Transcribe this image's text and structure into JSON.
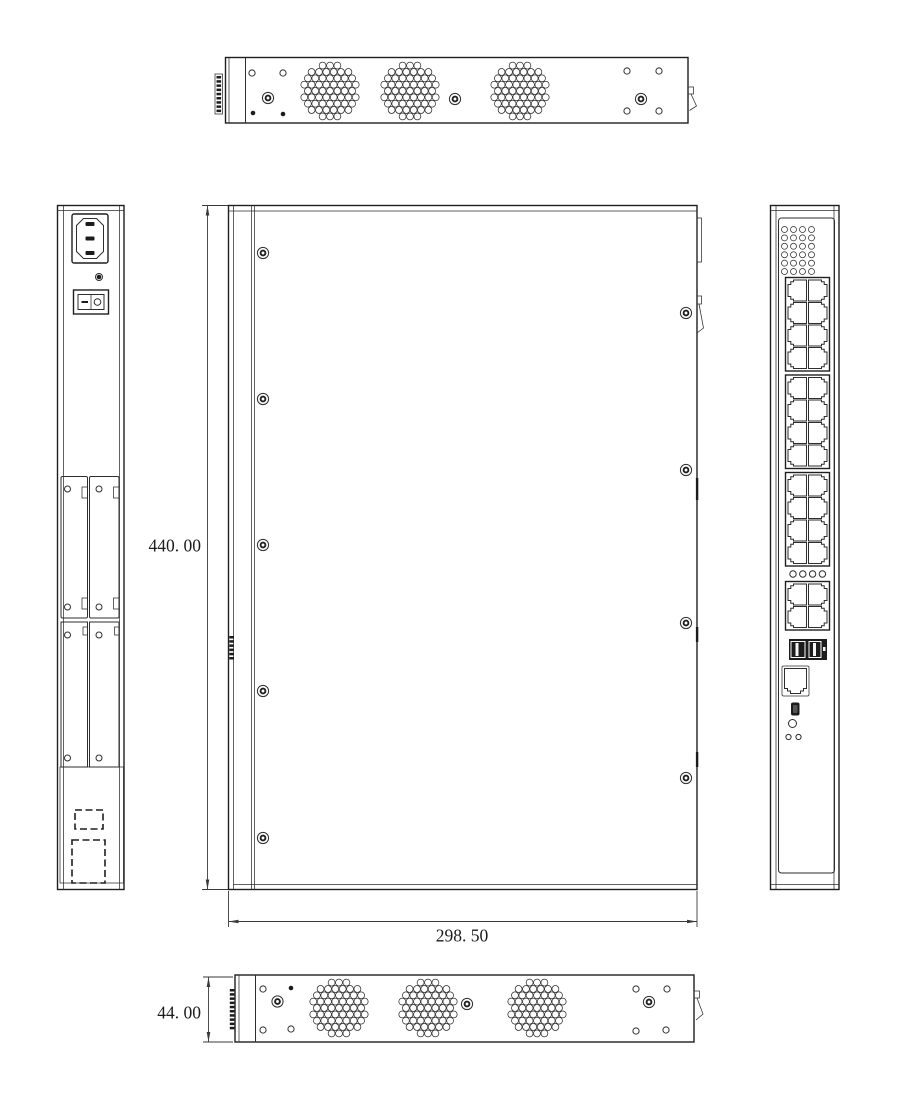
{
  "dimension_labels": {
    "height": "440. 00",
    "width": "298. 50",
    "depth": "44. 00"
  },
  "figure": {
    "top_view": {
      "serration": {
        "x": 216.5,
        "y": 76,
        "h": 37
      },
      "vent_clusters": [
        [
          330,
          91
        ],
        [
          410,
          91
        ],
        [
          520,
          91
        ]
      ],
      "big_screws": [
        [
          268,
          98
        ],
        [
          455,
          99
        ],
        [
          641,
          99
        ]
      ],
      "holes": [
        [
          252,
          73
        ],
        [
          283,
          73
        ],
        [
          627,
          71
        ],
        [
          659,
          71
        ],
        [
          627,
          111
        ],
        [
          659,
          111
        ]
      ],
      "dots": [
        [
          253,
          113
        ],
        [
          283,
          114
        ]
      ]
    },
    "bottom_view": {
      "serration": {
        "x": 229.8,
        "y": 989,
        "h": 42
      },
      "vent_clusters": [
        [
          339,
          1008
        ],
        [
          428,
          1008
        ],
        [
          537,
          1008
        ]
      ],
      "big_screws": [
        [
          277.5,
          1001.5
        ],
        [
          467,
          1004
        ],
        [
          649,
          1002
        ]
      ],
      "holes": [
        [
          263,
          989
        ],
        [
          263,
          1030
        ],
        [
          291,
          1029
        ],
        [
          636,
          989
        ],
        [
          667,
          989
        ],
        [
          636,
          1031
        ],
        [
          666,
          1030
        ]
      ],
      "dots": [
        [
          291,
          988
        ]
      ]
    },
    "center_view": {
      "left_screw_x": 263,
      "left_screw_ys": [
        253,
        399,
        545,
        691,
        838
      ],
      "right_screw_x": 686,
      "right_screw_ys": [
        313,
        470,
        623,
        778
      ],
      "serration": {
        "x": 229.3,
        "y": 636,
        "h": 24
      }
    },
    "left_view": {
      "power_inlet": {
        "x": 72,
        "y": 214,
        "w": 36,
        "h": 49
      },
      "inlet_screw": [
        99,
        277
      ],
      "power_switch": {
        "x": 73.5,
        "y": 290,
        "w": 35,
        "h": 24
      },
      "slot_covers": [
        {
          "x": 61,
          "y": 476.5,
          "w": 26.5,
          "h": 141.5
        },
        {
          "x": 89.5,
          "y": 476.5,
          "w": 29.5,
          "h": 141.5
        }
      ],
      "plates": [
        {
          "x": 61,
          "y": 622,
          "w": 26.5,
          "h": 145
        },
        {
          "x": 89.5,
          "y": 622,
          "w": 29.5,
          "h": 145
        }
      ],
      "screw_holes": [
        [
          67.5,
          489
        ],
        [
          99,
          489
        ],
        [
          67.5,
          607
        ],
        [
          99,
          607
        ],
        [
          67.5,
          635
        ],
        [
          99,
          635
        ],
        [
          67.5,
          758
        ],
        [
          99,
          758
        ]
      ],
      "bottom_recess": {
        "x": 60,
        "y": 767,
        "w": 63.5,
        "h": 116
      },
      "knockouts": [
        {
          "x": 75,
          "y": 810,
          "w": 28,
          "h": 19
        },
        {
          "x": 72,
          "y": 840,
          "w": 33,
          "h": 43
        }
      ]
    },
    "rear_view": {
      "led_grid": {
        "x": 784.5,
        "y": 229.5,
        "cols": 4,
        "rows": 6,
        "dx": 9,
        "dy": 8.4,
        "r": 3
      },
      "port_blocks": [
        {
          "x": 785.5,
          "y": 277.5,
          "rows": 4,
          "name": "ethernet-ports-1-8"
        },
        {
          "x": 785.5,
          "y": 375,
          "rows": 4,
          "name": "ethernet-ports-9-16"
        },
        {
          "x": 785.5,
          "y": 472.5,
          "rows": 4,
          "name": "ethernet-ports-17-24"
        },
        {
          "x": 785.5,
          "y": 581.5,
          "rows": 2,
          "name": "uplink-ports-25-28"
        }
      ],
      "led_row": {
        "x": 793,
        "y": 574,
        "count": 4,
        "dx": 9.8,
        "r": 3.2
      },
      "dual_module": {
        "x": 789,
        "y": 639,
        "w": 38,
        "h": 21
      },
      "console_port": {
        "x": 784.5,
        "y": 668.5,
        "w": 22,
        "h": 25
      },
      "mini_usb": {
        "x": 791,
        "y": 702.5,
        "w": 8.5,
        "h": 13
      },
      "reset_button": [
        792.5,
        723.5
      ],
      "indicator_leds": [
        [
          788.5,
          737
        ],
        [
          798.5,
          737
        ]
      ]
    }
  }
}
